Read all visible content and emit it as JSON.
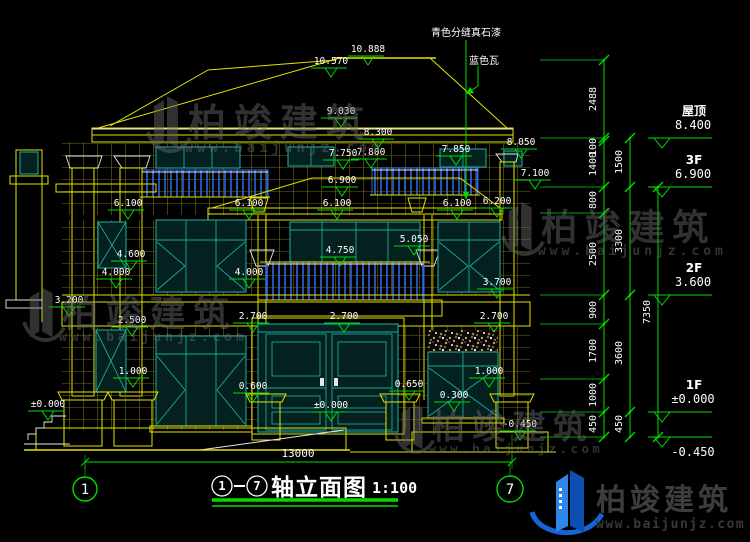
{
  "drawing": {
    "title_axis_start": "1",
    "title_axis_end": "7",
    "title_text": "轴立面图",
    "title_scale": "1:100",
    "axis_bubble_left": "1",
    "axis_bubble_right": "7",
    "bottom_dimension": "13000"
  },
  "notes": {
    "material_label": "青色分缝真石漆",
    "tile_label": "蓝色瓦"
  },
  "elevation_marks": [
    {
      "v": "10.888",
      "x": 368,
      "y": 52
    },
    {
      "v": "10.570",
      "x": 331,
      "y": 64
    },
    {
      "v": "9.030",
      "x": 341,
      "y": 114
    },
    {
      "v": "8.300",
      "x": 378,
      "y": 135
    },
    {
      "v": "8.050",
      "x": 521,
      "y": 145
    },
    {
      "v": "7.750",
      "x": 343,
      "y": 156
    },
    {
      "v": "7.800",
      "x": 371,
      "y": 155
    },
    {
      "v": "7.850",
      "x": 456,
      "y": 152
    },
    {
      "v": "7.100",
      "x": 535,
      "y": 176
    },
    {
      "v": "6.900",
      "x": 342,
      "y": 183
    },
    {
      "v": "6.100",
      "x": 128,
      "y": 206
    },
    {
      "v": "6.100",
      "x": 249,
      "y": 206
    },
    {
      "v": "6.100",
      "x": 337,
      "y": 206
    },
    {
      "v": "6.100",
      "x": 457,
      "y": 206
    },
    {
      "v": "6.200",
      "x": 497,
      "y": 204
    },
    {
      "v": "5.050",
      "x": 414,
      "y": 242
    },
    {
      "v": "4.750",
      "x": 340,
      "y": 253
    },
    {
      "v": "4.600",
      "x": 131,
      "y": 257
    },
    {
      "v": "4.000",
      "x": 116,
      "y": 275
    },
    {
      "v": "4.000",
      "x": 249,
      "y": 275
    },
    {
      "v": "3.700",
      "x": 497,
      "y": 285
    },
    {
      "v": "3.200",
      "x": 69,
      "y": 303
    },
    {
      "v": "2.700",
      "x": 253,
      "y": 319
    },
    {
      "v": "2.700",
      "x": 344,
      "y": 319
    },
    {
      "v": "2.700",
      "x": 494,
      "y": 319
    },
    {
      "v": "2.500",
      "x": 132,
      "y": 323
    },
    {
      "v": "1.000",
      "x": 133,
      "y": 374
    },
    {
      "v": "1.000",
      "x": 489,
      "y": 374
    },
    {
      "v": "0.650",
      "x": 409,
      "y": 387
    },
    {
      "v": "0.600",
      "x": 253,
      "y": 389
    },
    {
      "v": "0.300",
      "x": 454,
      "y": 398
    },
    {
      "v": "±0.000",
      "x": 48,
      "y": 407
    },
    {
      "v": "±0.000",
      "x": 331,
      "y": 408
    },
    {
      "v": "-0.450",
      "x": 520,
      "y": 427
    }
  ],
  "right_levels": [
    {
      "name": "屋顶",
      "elev": "8.400",
      "y": 138
    },
    {
      "name": "3F",
      "elev": "6.900",
      "y": 187
    },
    {
      "name": "2F",
      "elev": "3.600",
      "y": 295
    },
    {
      "name": "1F",
      "elev": "±0.000",
      "y": 412
    },
    {
      "name": "",
      "elev": "-0.450",
      "y": 437
    }
  ],
  "dim_chain": {
    "outer": {
      "x": 604,
      "ticks": [
        60,
        138,
        141,
        187,
        213,
        295,
        324,
        379,
        412,
        437
      ],
      "labels": [
        {
          "t": "2488",
          "y": 99
        },
        {
          "t": "100",
          "y": 147
        },
        {
          "t": "1400",
          "y": 164
        },
        {
          "t": "800",
          "y": 200
        },
        {
          "t": "2500",
          "y": 254
        },
        {
          "t": "900",
          "y": 310
        },
        {
          "t": "1700",
          "y": 351
        },
        {
          "t": "1000",
          "y": 395
        },
        {
          "t": "450",
          "y": 424
        }
      ]
    },
    "inner": {
      "x": 630,
      "ticks": [
        138,
        187,
        295,
        412,
        437
      ],
      "labels": [
        {
          "t": "1500",
          "y": 162
        },
        {
          "t": "3300",
          "y": 241
        },
        {
          "t": "3600",
          "y": 353
        },
        {
          "t": "450",
          "y": 424
        }
      ]
    },
    "total": {
      "x": 658,
      "ticks": [
        187,
        437
      ],
      "labels": [
        {
          "t": "7350",
          "y": 312
        }
      ]
    }
  },
  "watermark": {
    "name": "柏竣建筑",
    "url": "www.baijunjz.com",
    "instances": [
      {
        "x": 150,
        "y": 92,
        "s": 1.0
      },
      {
        "x": 505,
        "y": 198,
        "s": 0.95
      },
      {
        "x": 26,
        "y": 284,
        "s": 0.95
      },
      {
        "x": 398,
        "y": 400,
        "s": 0.88
      }
    ]
  },
  "logo": {
    "name": "柏竣建筑",
    "url": "www.baijunjz.com"
  },
  "colors": {
    "line_yellow": "#e6e300",
    "dimension_green": "#00dc00",
    "window_teal": "#1aa89c",
    "railing_blue": "#2e66e0",
    "text_white": "#ffffff",
    "watermark_gray": "#6f6f6f",
    "logo_blue": "#1565d8",
    "background": "#000000"
  }
}
